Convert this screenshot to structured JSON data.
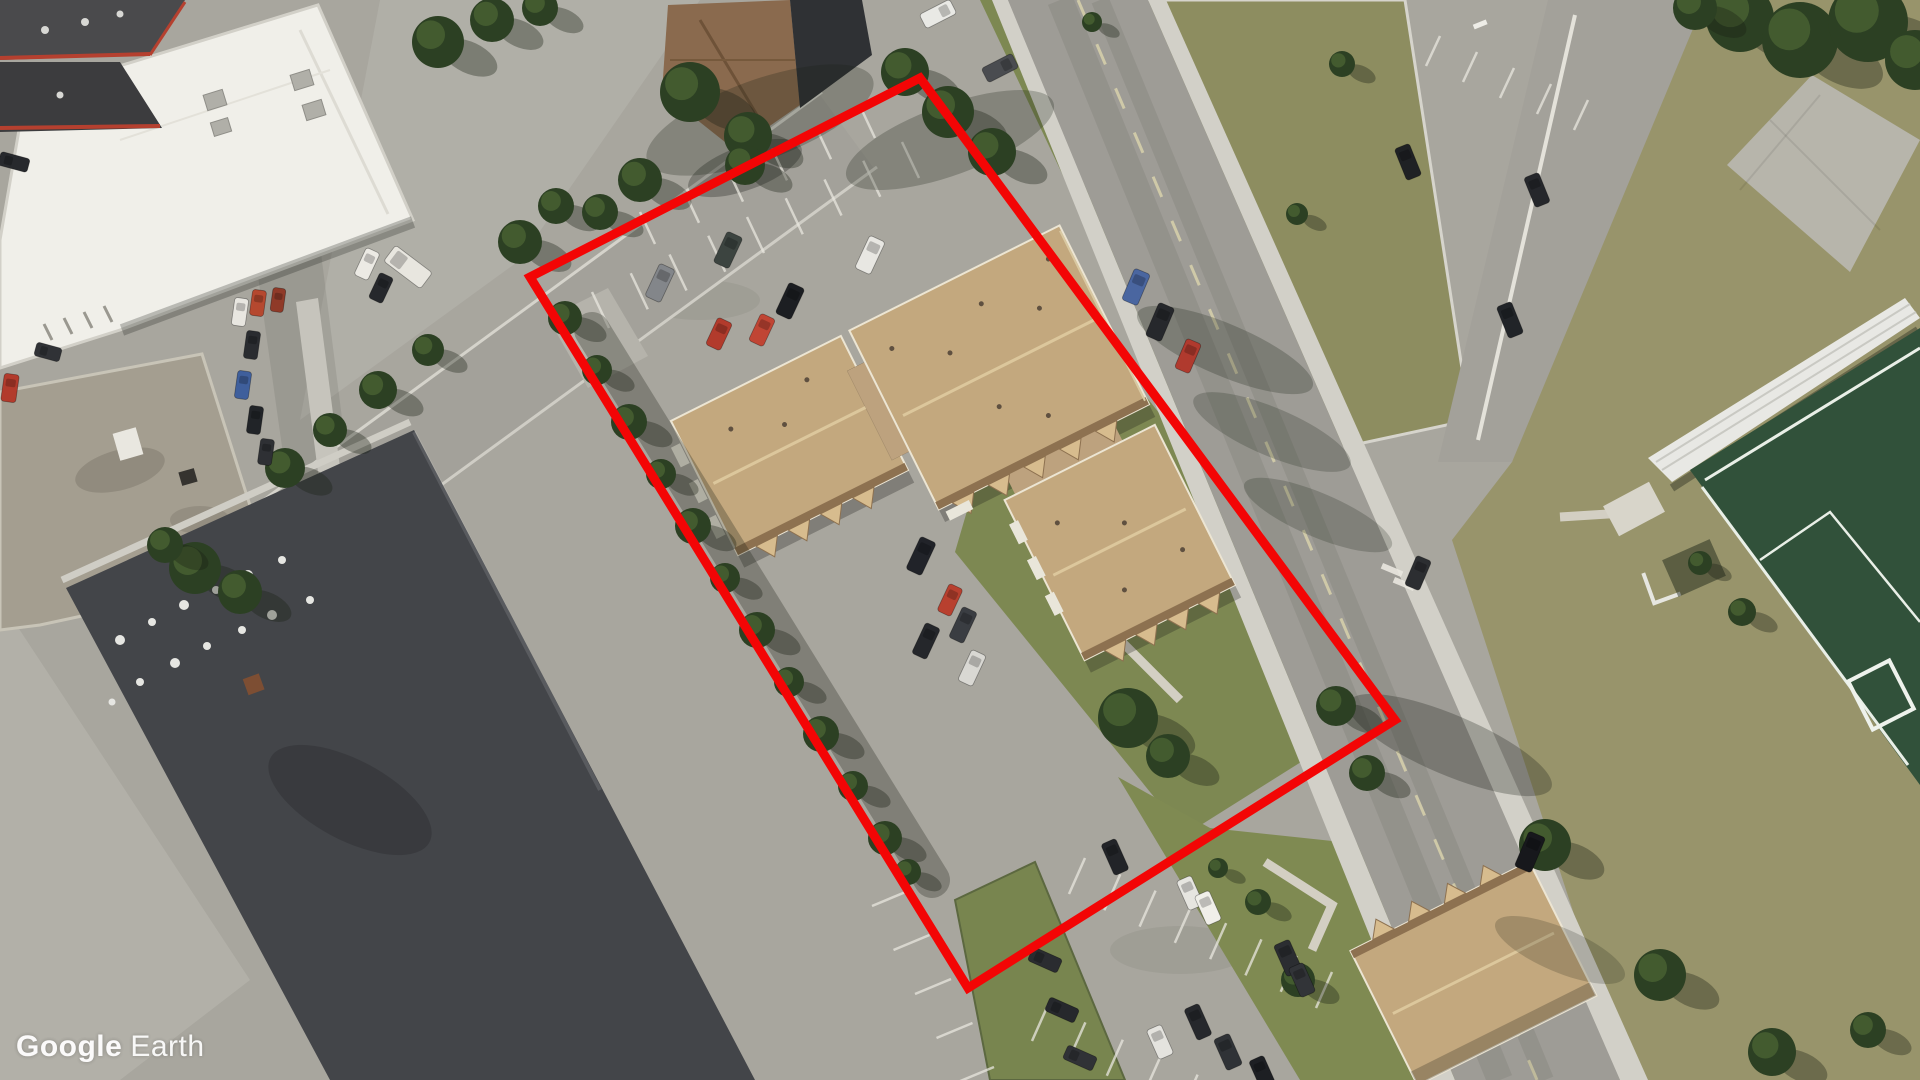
{
  "meta": {
    "application": "Google Earth",
    "view_type": "aerial-satellite-imagery"
  },
  "watermark": {
    "part1": "Google",
    "part2": "Earth",
    "color": "#ffffff"
  },
  "annotation": {
    "label": "property-parcel-outline",
    "color": "#f30505",
    "stroke_width": 9,
    "points": [
      [
        530,
        277
      ],
      [
        920,
        78
      ],
      [
        1395,
        720
      ],
      [
        968,
        988
      ]
    ]
  },
  "palette": {
    "pavement": "#a8a69e",
    "sidewalk": "#d2d0c8",
    "lawn": "#8d8d60",
    "scrub_grass": "#98946b",
    "parcel_grass": "#7d8852",
    "soccer_field": "#31513a",
    "field_line": "#e9efe7",
    "roof_tan": "#c3a87e",
    "roof_tan_shadow": "#8d7150",
    "roof_white": "#f0efe9",
    "roof_dark": "#45474b",
    "roof_weathered": "#a49e90",
    "tree": "#2c4023",
    "red_trim": "#b5402f"
  },
  "scene": {
    "cars": [
      [
        1136,
        287,
        17,
        34,
        23,
        "#4a66a0"
      ],
      [
        1160,
        322,
        17,
        36,
        23,
        "#26282c"
      ],
      [
        1188,
        356,
        16,
        32,
        23,
        "#b03a2e"
      ],
      [
        1418,
        573,
        16,
        32,
        23,
        "#2c2e31"
      ],
      [
        1530,
        852,
        18,
        38,
        23,
        "#17181c"
      ],
      [
        1408,
        162,
        16,
        34,
        -22,
        "#1f2124"
      ],
      [
        1537,
        190,
        16,
        32,
        -22,
        "#25272b"
      ],
      [
        1510,
        320,
        16,
        34,
        -22,
        "#212428"
      ],
      [
        938,
        14,
        16,
        34,
        63,
        "#e9e9e5"
      ],
      [
        1000,
        68,
        16,
        34,
        63,
        "#4a4c50"
      ],
      [
        660,
        283,
        17,
        36,
        25,
        "#83868a"
      ],
      [
        728,
        250,
        17,
        34,
        25,
        "#3c4440"
      ],
      [
        870,
        255,
        17,
        36,
        25,
        "#e8e7e2"
      ],
      [
        790,
        301,
        17,
        34,
        25,
        "#1c1e22"
      ],
      [
        719,
        334,
        16,
        30,
        25,
        "#b23b2c"
      ],
      [
        762,
        330,
        16,
        30,
        25,
        "#c04534"
      ],
      [
        921,
        556,
        17,
        36,
        25,
        "#212329"
      ],
      [
        926,
        641,
        16,
        34,
        25,
        "#25272b"
      ],
      [
        963,
        625,
        16,
        34,
        25,
        "#3a3d42"
      ],
      [
        972,
        668,
        16,
        34,
        25,
        "#d9d8d3"
      ],
      [
        950,
        600,
        15,
        30,
        25,
        "#b8402f"
      ],
      [
        1115,
        857,
        16,
        34,
        -24,
        "#222428"
      ],
      [
        1190,
        893,
        16,
        32,
        -24,
        "#e6e5e0"
      ],
      [
        1208,
        908,
        16,
        32,
        -24,
        "#f0efe9"
      ],
      [
        1288,
        958,
        17,
        34,
        -24,
        "#2b2d31"
      ],
      [
        1302,
        980,
        16,
        32,
        -24,
        "#323438"
      ],
      [
        1198,
        1022,
        16,
        34,
        -24,
        "#26282c"
      ],
      [
        1160,
        1042,
        16,
        32,
        -24,
        "#e4e3de"
      ],
      [
        1228,
        1052,
        17,
        34,
        -24,
        "#2f3236"
      ],
      [
        1262,
        1072,
        16,
        30,
        -24,
        "#1d1f23"
      ],
      [
        1045,
        960,
        15,
        32,
        -66,
        "#2a2c30"
      ],
      [
        1062,
        1010,
        15,
        32,
        -66,
        "#26282c"
      ],
      [
        1080,
        1058,
        15,
        32,
        -66,
        "#303236"
      ],
      [
        240,
        312,
        14,
        28,
        8,
        "#e8e6e0"
      ],
      [
        258,
        303,
        14,
        26,
        8,
        "#b5482f"
      ],
      [
        278,
        300,
        13,
        24,
        8,
        "#8f3a28"
      ],
      [
        252,
        345,
        14,
        28,
        8,
        "#2a2c30"
      ],
      [
        243,
        385,
        14,
        28,
        8,
        "#3f5f9c"
      ],
      [
        255,
        420,
        14,
        28,
        8,
        "#212428"
      ],
      [
        266,
        452,
        14,
        26,
        8,
        "#2e3034"
      ],
      [
        14,
        162,
        14,
        30,
        -75,
        "#27292d"
      ],
      [
        10,
        388,
        15,
        28,
        8,
        "#b23b2c"
      ],
      [
        48,
        352,
        14,
        26,
        -75,
        "#303236"
      ],
      [
        367,
        264,
        15,
        30,
        25,
        "#eceae4"
      ],
      [
        381,
        288,
        15,
        28,
        25,
        "#26282c"
      ],
      [
        408,
        267,
        20,
        46,
        -53,
        "#e8e6df"
      ]
    ],
    "trees": [
      [
        565,
        318,
        17
      ],
      [
        597,
        370,
        15
      ],
      [
        629,
        422,
        18
      ],
      [
        661,
        474,
        15
      ],
      [
        693,
        526,
        18
      ],
      [
        725,
        578,
        15
      ],
      [
        757,
        630,
        18
      ],
      [
        789,
        682,
        15
      ],
      [
        821,
        734,
        18
      ],
      [
        853,
        786,
        15
      ],
      [
        885,
        838,
        17
      ],
      [
        908,
        872,
        13
      ],
      [
        285,
        468,
        20
      ],
      [
        330,
        430,
        17
      ],
      [
        378,
        390,
        19
      ],
      [
        428,
        350,
        16
      ],
      [
        195,
        568,
        26
      ],
      [
        240,
        592,
        22
      ],
      [
        165,
        545,
        18
      ],
      [
        438,
        42,
        26
      ],
      [
        492,
        20,
        22
      ],
      [
        540,
        8,
        18
      ],
      [
        520,
        242,
        22
      ],
      [
        556,
        206,
        18
      ],
      [
        690,
        92,
        30
      ],
      [
        748,
        136,
        24
      ],
      [
        640,
        180,
        22
      ],
      [
        600,
        212,
        18
      ],
      [
        905,
        72,
        24
      ],
      [
        948,
        112,
        26
      ],
      [
        992,
        152,
        24
      ],
      [
        745,
        165,
        20
      ],
      [
        1092,
        22,
        10
      ],
      [
        1342,
        64,
        13
      ],
      [
        1297,
        214,
        11
      ],
      [
        1128,
        718,
        30
      ],
      [
        1168,
        756,
        22
      ],
      [
        1336,
        706,
        20
      ],
      [
        1367,
        773,
        18
      ],
      [
        1545,
        845,
        26
      ],
      [
        1660,
        975,
        26
      ],
      [
        1772,
        1052,
        24
      ],
      [
        1868,
        1030,
        18
      ],
      [
        1700,
        563,
        12
      ],
      [
        1742,
        612,
        14
      ],
      [
        1258,
        902,
        13
      ],
      [
        1298,
        980,
        17
      ],
      [
        1218,
        868,
        10
      ],
      [
        1740,
        18,
        34
      ],
      [
        1800,
        40,
        38
      ],
      [
        1868,
        22,
        40
      ],
      [
        1915,
        60,
        30
      ],
      [
        1695,
        8,
        22
      ]
    ],
    "street_shadows": [
      [
        1225,
        350,
        95,
        26,
        23,
        0.25
      ],
      [
        1272,
        432,
        85,
        24,
        23,
        0.22
      ],
      [
        1318,
        515,
        80,
        22,
        23,
        0.22
      ],
      [
        1450,
        745,
        110,
        30,
        23,
        0.28
      ],
      [
        1560,
        950,
        70,
        22,
        23,
        0.2
      ],
      [
        760,
        120,
        120,
        40,
        -20,
        0.25
      ],
      [
        950,
        140,
        110,
        35,
        -20,
        0.25
      ]
    ]
  }
}
